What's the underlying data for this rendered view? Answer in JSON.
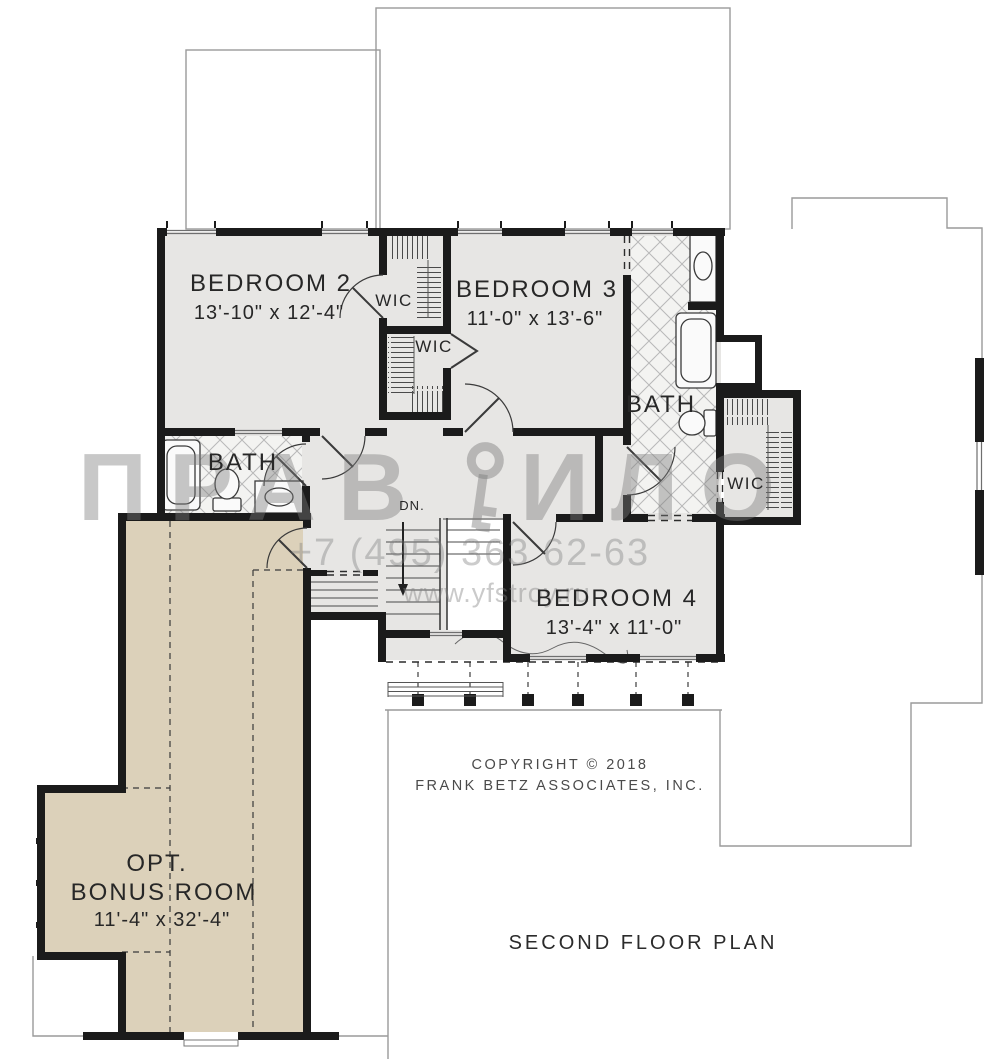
{
  "title": "SECOND FLOOR PLAN",
  "copyright": {
    "line1": "COPYRIGHT  ©  2018",
    "line2": "FRANK BETZ ASSOCIATES, INC."
  },
  "watermark": {
    "brand_left": "ПРАВ",
    "brand_right": "ИЛО",
    "phone": "+7 (495) 363 62-63",
    "website": "www.yfstroy.ru"
  },
  "rooms": {
    "bedroom2": {
      "name": "BEDROOM 2",
      "dims": "13'-10\" x 12'-4\""
    },
    "bedroom3": {
      "name": "BEDROOM 3",
      "dims": "11'-0\" x 13'-6\""
    },
    "bedroom4": {
      "name": "BEDROOM 4",
      "dims": "13'-4\" x 11'-0\""
    },
    "bonus": {
      "name_line1": "OPT.",
      "name_line2": "BONUS ROOM",
      "dims": "11'-4\" x 32'-4\""
    },
    "bath_left": {
      "name": "BATH"
    },
    "bath_right": {
      "name": "BATH"
    },
    "wic1": {
      "name": "WIC"
    },
    "wic2": {
      "name": "WIC"
    },
    "wic3": {
      "name": "WIC"
    }
  },
  "stairs": {
    "down_label": "DN."
  },
  "colors": {
    "wall": "#1b1b1b",
    "floor": "#e7e6e4",
    "bonus_floor": "#dcd1ba",
    "tile": "#f3f3f1",
    "outline": "#9a9a9a"
  }
}
